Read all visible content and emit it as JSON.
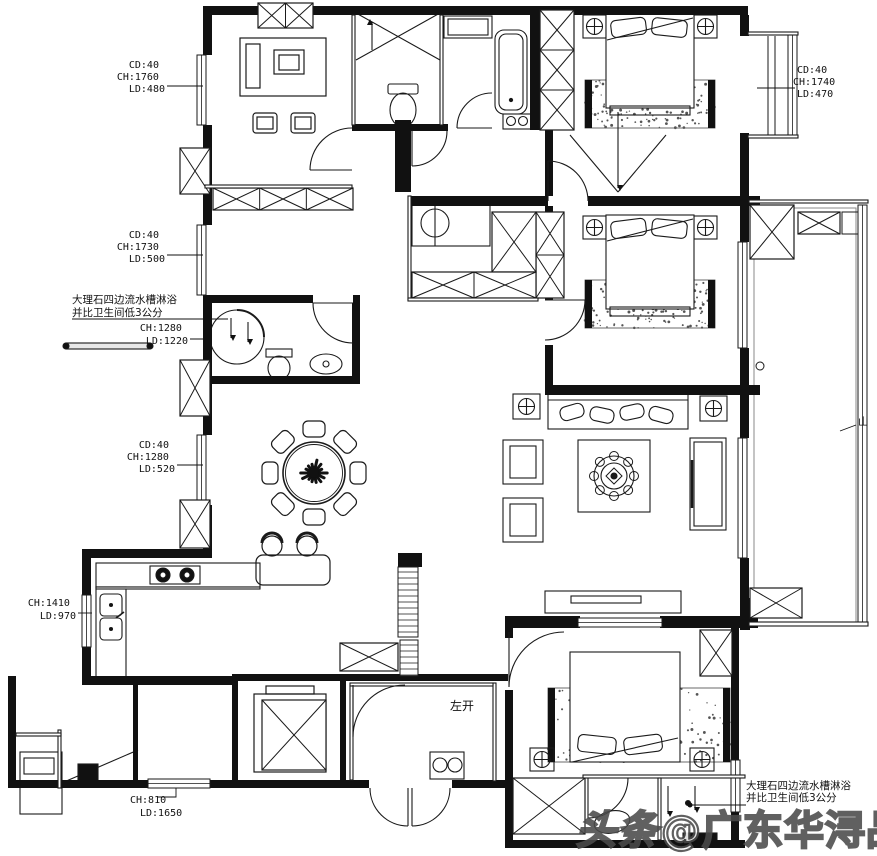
{
  "annotations": [
    {
      "id": "window-top-left",
      "lines": [
        "CD:40",
        "CH:1760",
        "LD:480"
      ]
    },
    {
      "id": "window-mid-left",
      "lines": [
        "CD:40",
        "CH:1730",
        "LD:500"
      ]
    },
    {
      "id": "marble-note-left",
      "lines": [
        "大理石四边流水槽淋浴",
        "并比卫生间低3公分"
      ]
    },
    {
      "id": "shower-left",
      "lines": [
        "CH:1280",
        "LD:1220"
      ]
    },
    {
      "id": "window-dining",
      "lines": [
        "CD:40",
        "CH:1280",
        "LD:520"
      ]
    },
    {
      "id": "kitchen-window",
      "lines": [
        "CH:1410",
        "LD:970"
      ]
    },
    {
      "id": "bottom-window",
      "lines": [
        "CH:810",
        "LD:1650"
      ]
    },
    {
      "id": "window-top-right",
      "lines": [
        "CD:40",
        "CH:1740",
        "LD:470"
      ]
    },
    {
      "id": "door-left-open",
      "lines": [
        "左开"
      ]
    },
    {
      "id": "marble-note-right",
      "lines": [
        "大理石四边流水槽淋浴",
        "并比卫生间低3公分"
      ]
    },
    {
      "id": "right-edge-partial",
      "lines": [
        "山"
      ]
    }
  ],
  "watermark": {
    "logo": "头条",
    "text": "@广东华浔品味装饰"
  },
  "colors": {
    "wall": "#111111",
    "line": "#1a1a1a",
    "background": "#ffffff",
    "watermark": "#4b4b4b"
  }
}
